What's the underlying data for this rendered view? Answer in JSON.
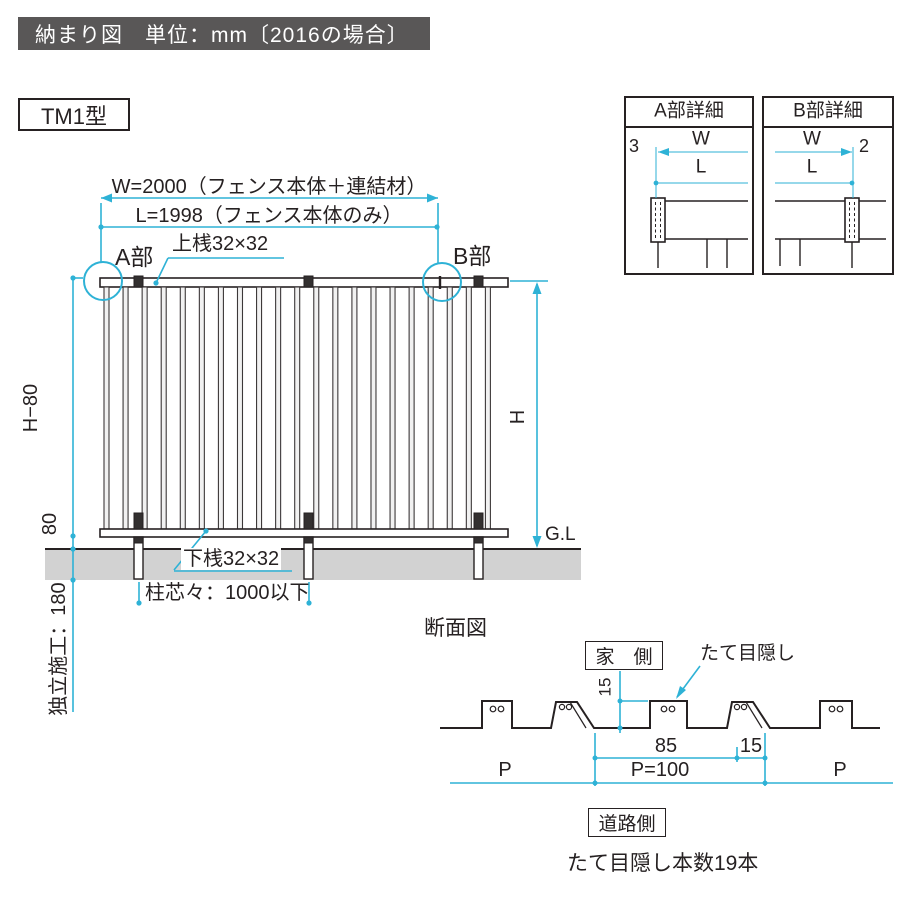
{
  "header": {
    "title": "納まり図　単位：mm〔2016の場合〕"
  },
  "model_label": "TM1型",
  "colors": {
    "accent": "#2eb2d6",
    "header_bg": "#595757",
    "ground": "#d2d2d2",
    "line": "#262122"
  },
  "elevation": {
    "dim_w": "W=2000（フェンス本体＋連結材）",
    "dim_l": "L=1998（フェンス本体のみ）",
    "top_rail": "上桟32×32",
    "bottom_rail": "下桟32×32",
    "part_a": "A部",
    "part_b": "B部",
    "dim_h_minus_80": "H−80",
    "dim_80": "80",
    "dim_h": "H",
    "ground_level": "G.L",
    "post_pitch": "柱芯々：1000以下",
    "embedment": "独立施工：180",
    "slat_count_visible": 21
  },
  "details": {
    "a": {
      "title": "A部詳細",
      "w": "W",
      "l": "L",
      "offset": "3"
    },
    "b": {
      "title": "B部詳細",
      "w": "W",
      "l": "L",
      "offset": "2"
    }
  },
  "section": {
    "title": "断面図",
    "house_side": "家　側",
    "road_side": "道路側",
    "slat_label": "たて目隠し",
    "dim_height": "15",
    "dim_85": "85",
    "dim_15": "15",
    "p_left": "P",
    "p_eq": "P=100",
    "p_right": "P",
    "note": "たて目隠し本数19本"
  }
}
